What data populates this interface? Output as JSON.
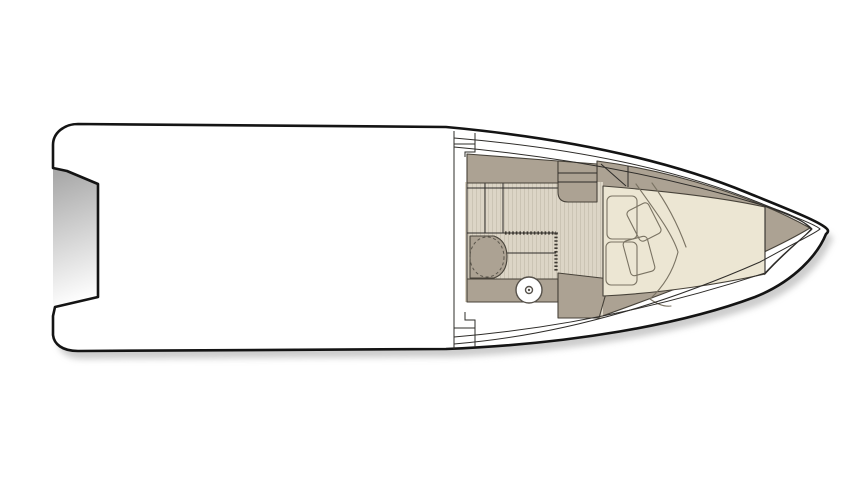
{
  "meta": {
    "type": "boat-floor-plan",
    "view": "top-down deck and cabin layout, bow pointing right",
    "visible_text": ""
  },
  "canvas": {
    "width": 862,
    "height": 485,
    "background": "#ffffff"
  },
  "colors": {
    "background": "#ffffff",
    "hull_fill": "#ffffff",
    "outline": "#141414",
    "line_thin": "#2e2c29",
    "furniture": "#aca293",
    "furniture_outline": "#474239",
    "floor_base": "#dcd5c6",
    "floor_stripe": "#cbc4b4",
    "bed": "#ece6d3",
    "cushion": "#f0eadb",
    "cushion_outline": "#7a7363",
    "white_deck": "#ffffff",
    "shadow": "#9a9a9a",
    "notch_shade_dark": "#a9a9a9",
    "notch_shade_light": "#ffffff"
  },
  "components": {
    "hull": "hull outline with pointed bow (right) and notched transom (left)",
    "stern_notch": "recessed transom cutout with shaded gradient",
    "main_deck": "open white deck area amidships",
    "cabin": {
      "bulkhead": "aft cabin bulkhead with step moldings",
      "top_cabinet_run": "locker band along port side",
      "companionway_steps": "stepped unit with two tread lines",
      "teak_floor": "striped cabin sole",
      "wet_room": {
        "vanity_sink": "vanity with bulged front and dashed round basin",
        "sliding_door_track": "dotted door track on top and right edges",
        "toilet": "round toilet with center dot",
        "counter": "counter band under toilet"
      },
      "v_berth": {
        "bed": "cream V-shaped bed filling the bow",
        "pillows": 2,
        "angled_cushions": 2,
        "blanket": "folded throw drawn with curved lines"
      },
      "side_shelves": "tapering shelf bands along both hull sides",
      "bow_locker": "white triangular foredeck locker at bow tip"
    }
  }
}
